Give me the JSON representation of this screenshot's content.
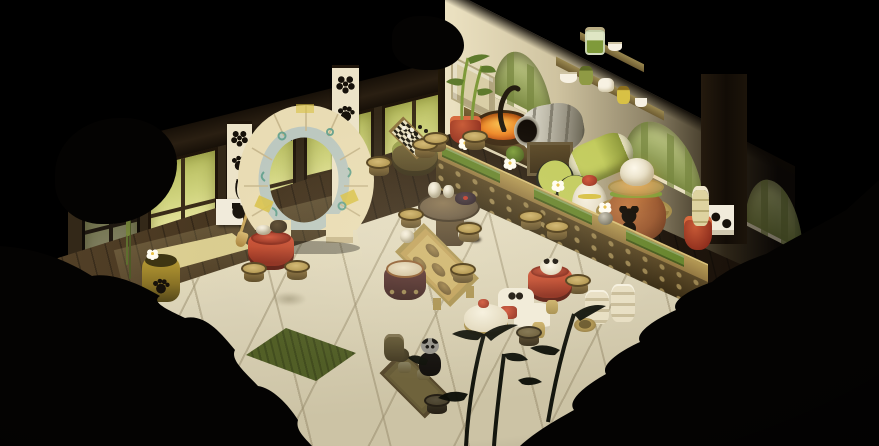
{
  "scene": {
    "name": "isometric-panda-tavern-room",
    "description": "isometric game interior, panda-themed tea house with moon arch, glowing windows, kitchen counter and tea tables",
    "visible_text": []
  },
  "objects": [
    "left-window-wall",
    "paw-banner",
    "flower-banner",
    "moon-gate-arch",
    "panda-panel",
    "broom",
    "chess-table",
    "chess-stools",
    "round-side-table",
    "square-tea-table",
    "drum-seat",
    "red-round-table",
    "panda-bowl",
    "white-bench",
    "red-cushion",
    "cloth-table",
    "bowl-stacks",
    "basket",
    "bar-counter",
    "white-lotus-flowers",
    "cooking-wok",
    "ladle",
    "metal-still-keg",
    "keg-stand",
    "wall-shelf",
    "glass-jar",
    "sake-jug",
    "green-panda-barrels",
    "tilted-barrel",
    "brown-panda-pot",
    "rice-ball",
    "pot-stand",
    "bamboo-plant-pot",
    "bamboo-bottle-pot",
    "panda-spot-block",
    "paw-print-drum",
    "straw-mat",
    "green-mat",
    "panda-plush",
    "low-tea-table",
    "storage-jar",
    "wall-pillar",
    "arched-bamboo-windows",
    "stone-relief",
    "stools",
    "foreground-bamboo",
    "shadow-rocks"
  ],
  "palette": {
    "bg": "#000000",
    "eaves": "#2a1f12",
    "eaves-dark": "#171008",
    "wall-wood": "#332818",
    "frame": "#1f150a",
    "glass-1": "#b6bc5e",
    "glass-2": "#cfd37d",
    "glass-3": "#ebe7a3",
    "mullion": "#3a2c18",
    "post": "#241a0c",
    "right-wall-1": "#ece2c2",
    "right-wall-2": "#cfc3a0",
    "right-wall-3": "#8f8468",
    "right-wall-4": "#2e2618",
    "arch-fill": "#a3af6a",
    "arch-stalk-l": "#ccd392",
    "arch-stalk-d": "#76863e",
    "arch-sill": "#e9e0c2",
    "relief": "#d9cea6",
    "relief-line": "#b4a880",
    "beam-1": "#241a0e",
    "beam-2": "#120c06",
    "white-panel": "#f1ebdb",
    "ink": "#16110a",
    "banner-cream": "#ece3c8",
    "floor-1": "#5a472c",
    "floor-2": "#3f2f1b",
    "floor-3": "#261b10",
    "floor-4": "#140d07",
    "plank": "#2c2011",
    "tatami-1": "#f0ead6",
    "tatami-2": "#e2dac0",
    "tatami-3": "#ccc3a5",
    "seam": "#968a6b",
    "straw": "#cfc083",
    "straw-edge": "#e3d79a",
    "mat-green": "#5c6a2c",
    "mat-green-dark": "#434f1e",
    "stone": "#e9dcb4",
    "stone-shade": "#c8b88e",
    "arch-inner": "#bcc8c0",
    "arch-teal": "#5f9f8c",
    "arch-yellow": "#d8c145",
    "counter-top": "#b59a55",
    "counter-top-dark": "#8f7440",
    "counter-green": "#69862f",
    "counter-face-1": "#5c4a28",
    "counter-face-2": "#3a2d15",
    "stud": "#9a8450",
    "stool-top": "#d4ba76",
    "stool-mid": "#b59a55",
    "stool-body": "#8f7440",
    "stool-dark": "#5c4a26",
    "gold-1": "#cdb26a",
    "gold-2": "#a8904e",
    "red-1": "#c04a2e",
    "red-2": "#8c2c1c",
    "red-3": "#d2553a",
    "wok-rim": "#3a2712",
    "wok-1": "#f8c050",
    "wok-2": "#ef8a28",
    "wok-3": "#b84a14",
    "metal-1": "#efece0",
    "metal-2": "#c2beae",
    "metal-3": "#8d8878",
    "metal-4": "#5e5a48",
    "barrel-green-1": "#c3cc5e",
    "barrel-green-2": "#8f9a3c",
    "barrel-cream": "#e6e0bd",
    "barrel-ring": "#23251c",
    "jug-white": "#f7f1e2",
    "jug-shade": "#d9cfb2",
    "pot-1": "#c07a45",
    "pot-2": "#9c5b33",
    "pot-3": "#6e3c20",
    "pot-green": "#7fa03c",
    "lid": "#cdb475",
    "rice-1": "#fdf8ea",
    "rice-2": "#d9cdab",
    "shelf-wood": "#9a8850",
    "shelf-wood-d": "#6e5c32",
    "olive-jar": "#8f9a44",
    "yellow-jar": "#d8c145",
    "glass-green": "#7f9a3a",
    "bench-white": "#f1ebd9",
    "bench-shade": "#cfc7ae",
    "plush-black": "#1e1812",
    "plush-white": "#f2ecdc",
    "drum-yellow-1": "#bb9e35",
    "drum-yellow-2": "#8a7326",
    "drum-yellow-3": "#55481a",
    "drumseat-1": "#5c3230",
    "drumseat-2": "#3a1f1e",
    "cream-top": "#ece0c4",
    "sil": "#040302",
    "bamboo-sil": "#0d0f08",
    "glow": "#fff6d6"
  }
}
